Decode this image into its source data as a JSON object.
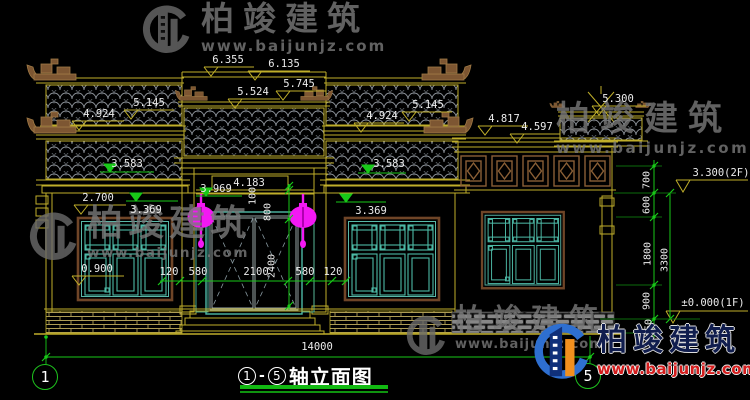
{
  "drawing": {
    "type": "architectural-elevation",
    "overall_width_mm": "14000"
  },
  "levels": {
    "l6135": "6.135",
    "l6355": "6.355",
    "l5524": "5.524",
    "l5745": "5.745",
    "l5145a": "5.145",
    "l4924a": "4.924",
    "l5145b": "5.145",
    "l4924b": "4.924",
    "l3583a": "3.583",
    "l3583b": "3.583",
    "l3969": "3.969",
    "l4183": "4.183",
    "l2700": "2.700",
    "l3369a": "3.369",
    "l3369b": "3.369",
    "l0900": "0.900",
    "l4817": "4.817",
    "l4597": "4.597",
    "l5300": "5.300",
    "l3300": "3.300(2F)",
    "l0000": "±0.000(1F)"
  },
  "h_dims": {
    "d120a": "120",
    "d580a": "580",
    "d2100": "2100",
    "d580b": "580",
    "d120b": "120",
    "d14000": "14000"
  },
  "v_dims": {
    "d100": "100",
    "d800": "800",
    "d2400": "2400",
    "d700": "700",
    "d600": "600",
    "d1800": "1800",
    "d3300": "3300",
    "d900": "900",
    "d450": "450"
  },
  "axis": {
    "left": "1",
    "right": "5"
  },
  "title": {
    "axis_left": "1",
    "dash": "-",
    "axis_right": "5",
    "text": "轴立面图"
  },
  "watermark": {
    "brand": "柏竣建筑",
    "url": "www.baijunjz.com"
  },
  "colors": {
    "cad_yellow": "#bfae2a",
    "cad_green": "#18c918",
    "cad_teal": "#4db9a6",
    "lantern_magenta": "#f318f3",
    "ornament_brown": "#7d5632",
    "logo_blue": "#2e6fd0",
    "logo_orange": "#f2901e",
    "url_red": "#d41c1c"
  }
}
